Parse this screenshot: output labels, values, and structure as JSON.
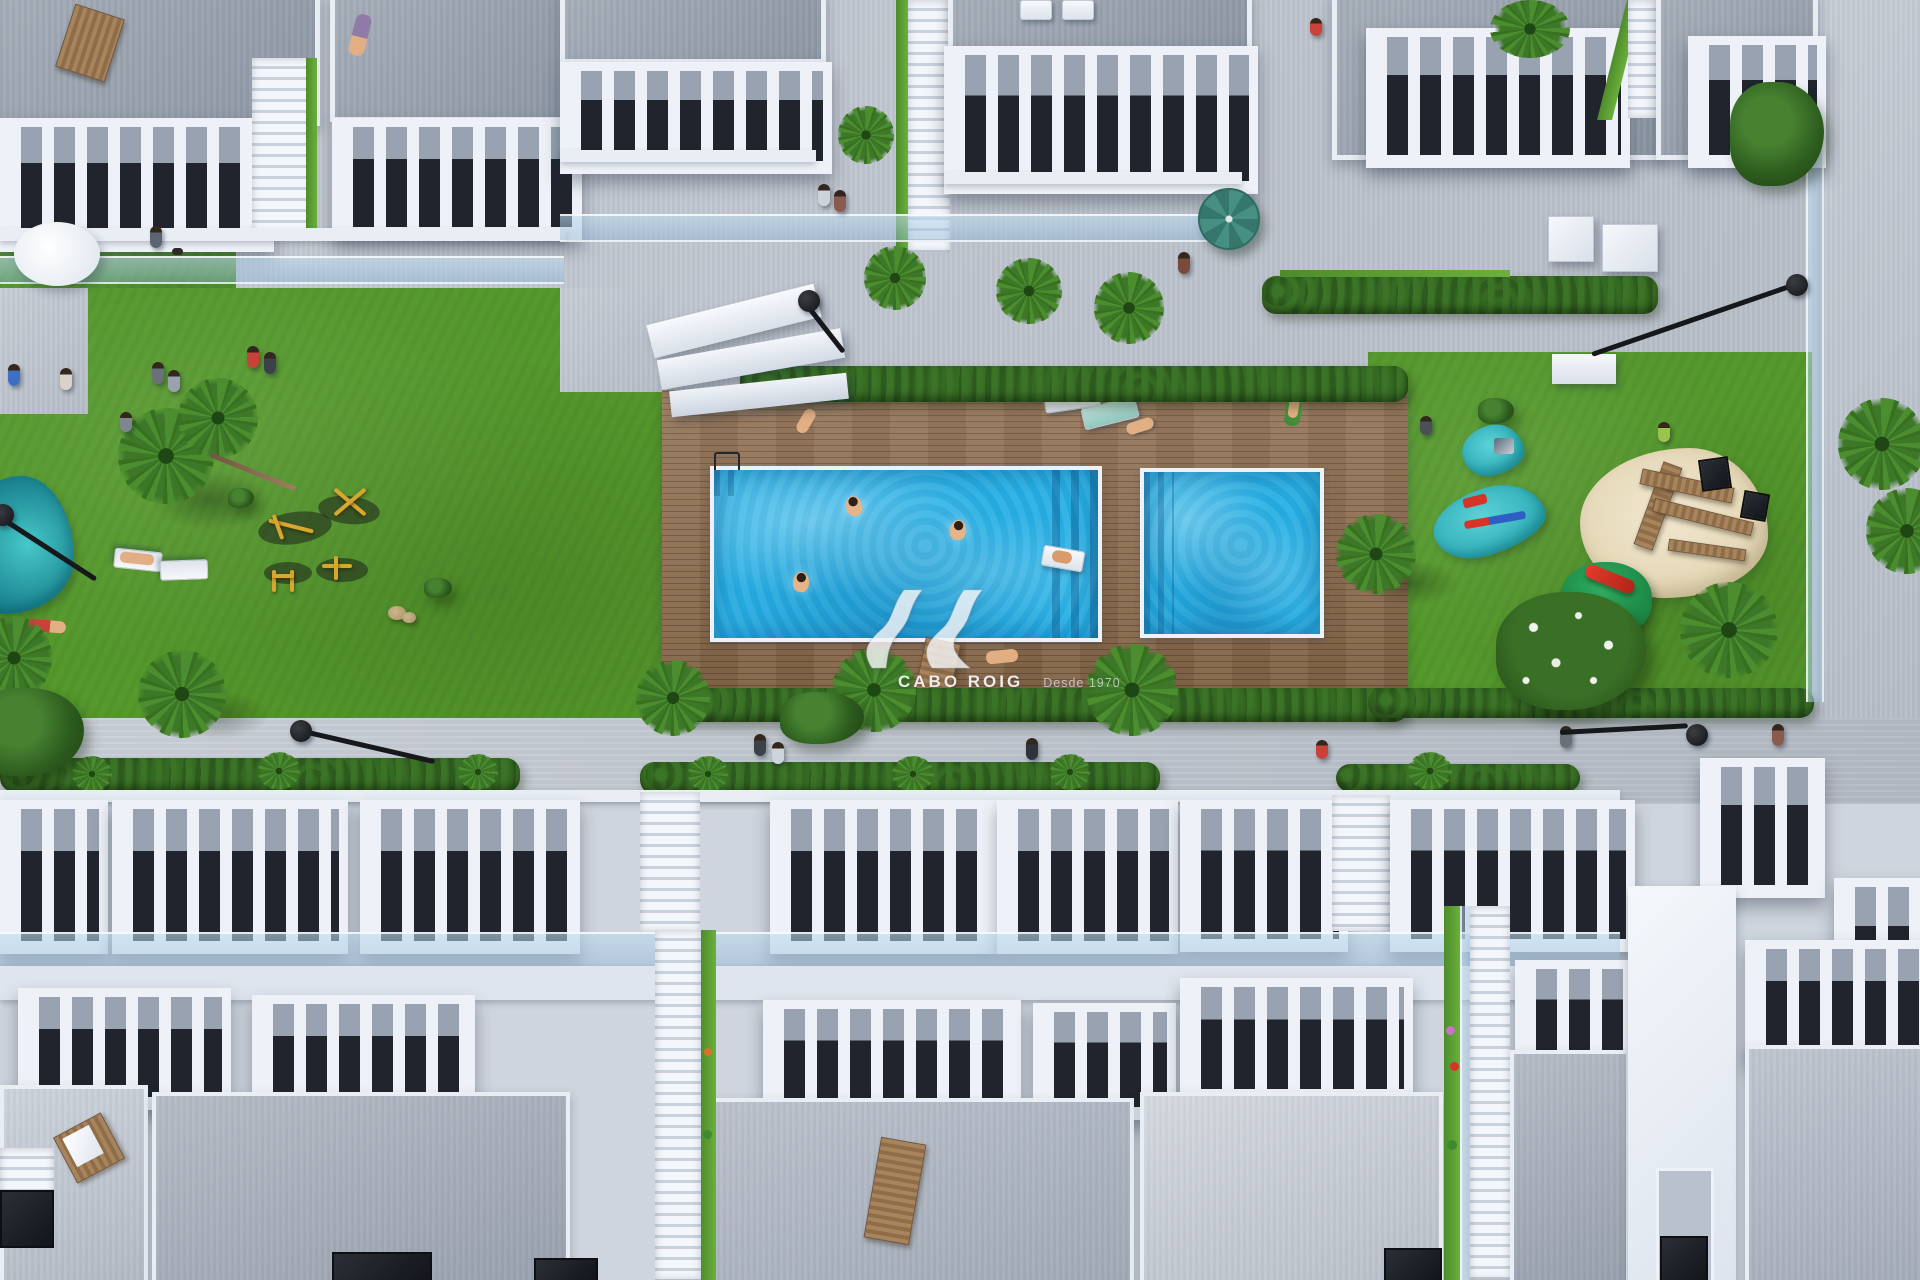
{
  "scene": {
    "type": "aerial-3d-architectural-render",
    "description": "Top-down aerial render of a white residential townhouse complex with a communal hardwood pool deck, rectangular swimming pool with wide entry steps, secondary plunge pool, lawned gardens with palm trees, outdoor gym, children's playground with sand pit, splash pads and slide, pedestrian promenades with street lamps, and rooftop terraces with sun loungers and wooden furniture",
    "features": [
      "main swimming pool with swimmers and inflatable float",
      "plunge pool",
      "timber pool deck with sun loungers and bench",
      "left lawn with twin palms, outdoor gym equipment and splash pond",
      "right lawn playground: splash pads, sand pit with wooden climbing frame, green mound with red slide, flowering bush",
      "two rows of white townhouses with balustraded balconies and rooftop terraces",
      "green-edged staircase alleys between townhouses",
      "street lamps, teal parasol, white cube planters, hedges and palm trees",
      "people walking, sunbathing and swimming"
    ]
  },
  "watermark": {
    "logo": "av-wave-monogram-icon",
    "brand": "CABO ROIG",
    "tagline": "Desde 1970"
  },
  "palette": {
    "walkway": "#c3c9d3",
    "street": "#c6ccd5",
    "roof": "#9aa3b0",
    "wall_white": "#eef2f8",
    "terrace_dark": "#20252d",
    "lawn": "#55982c",
    "hedge": "#2d5a1e",
    "deck": "#8d6b4c",
    "pool": "#28b0e4",
    "splash": "#2aa9b4",
    "sand": "#e3d6b4",
    "umbrella": "#468f82",
    "lamp": "#101215",
    "gym_yellow": "#d7a72e",
    "slide_red": "#d63427",
    "watermark_white": "#ffffff"
  }
}
